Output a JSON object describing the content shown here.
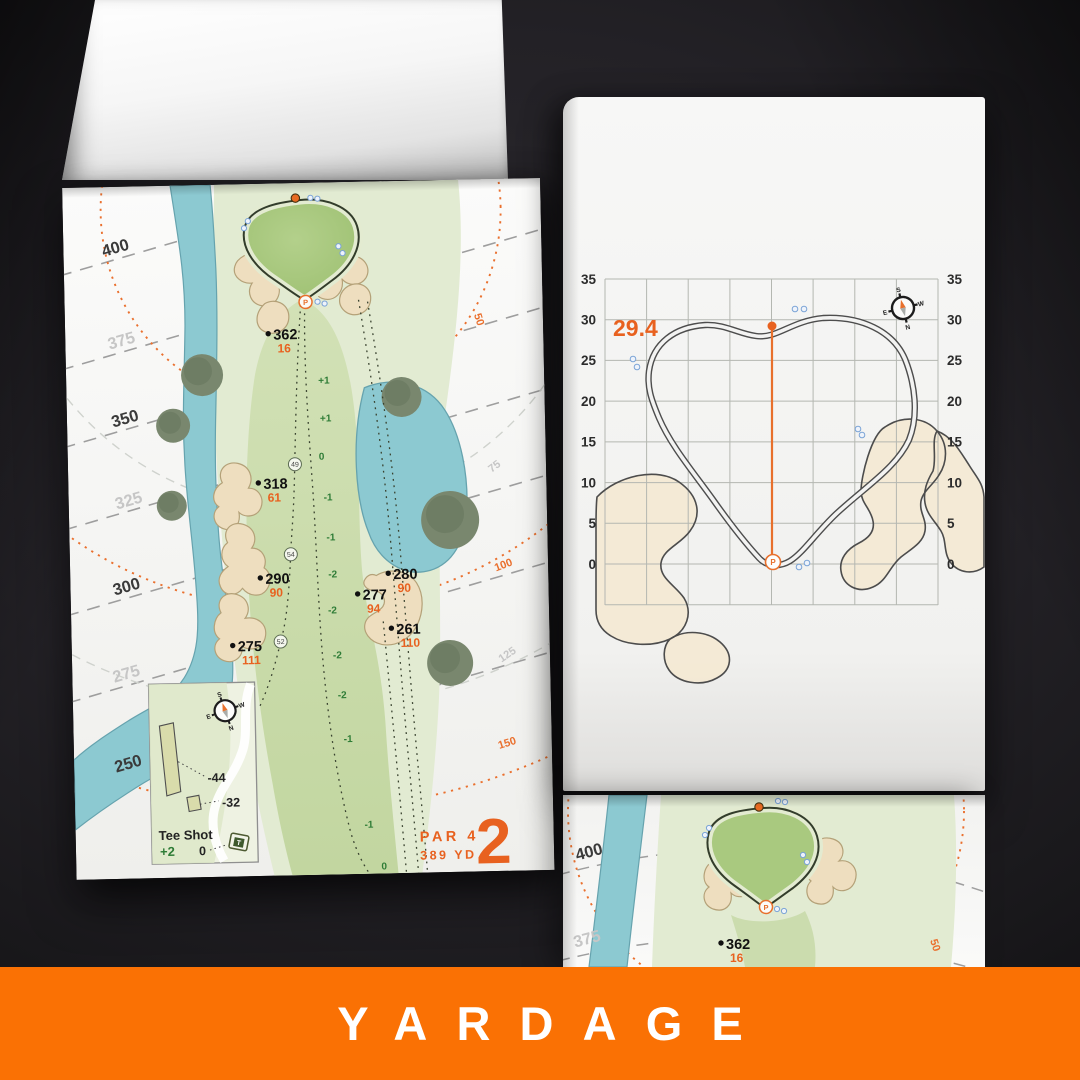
{
  "banner": {
    "label": "YARDAGE"
  },
  "colors": {
    "banner_orange": "#fa7104",
    "accent_orange": "#e8611f",
    "arc_orange": "#ea702e",
    "water": "#8cc9d1",
    "fairway": "#cbdcae",
    "rough": "#e2ebd2",
    "putting_green": "#a9c97f",
    "sand": "#eedebf",
    "value_green": "#2e7c36",
    "label_dark": "#3a3a3a",
    "label_light": "#c6c6c6"
  },
  "hole_card": {
    "par": "PAR 4",
    "yards": "389 YD",
    "number": "2"
  },
  "left_map": {
    "tee_lines": [
      "400",
      "375",
      "350",
      "325",
      "300",
      "275",
      "250"
    ],
    "pin_arcs": [
      "50",
      "75",
      "100",
      "125",
      "150"
    ],
    "markers": [
      {
        "dist": "362",
        "front": "16"
      },
      {
        "dist": "318",
        "front": "61"
      },
      {
        "dist": "290",
        "front": "90"
      },
      {
        "dist": "280",
        "front": "90"
      },
      {
        "dist": "277",
        "front": "94"
      },
      {
        "dist": "261",
        "front": "110"
      },
      {
        "dist": "275",
        "front": "111"
      }
    ],
    "center_vals": [
      "+1",
      "+1",
      "0",
      "-1",
      "-1",
      "-2",
      "-2",
      "-2",
      "-2",
      "-1",
      "-1",
      "0"
    ],
    "circle_vals": [
      "49",
      "54",
      "52"
    ],
    "pin_letter": "P",
    "inset": {
      "title": "Tee Shot",
      "score": "+2",
      "zero": "0",
      "long": "-44",
      "short": "-32",
      "tee": "T"
    },
    "compass": {
      "n": "N",
      "s": "S",
      "e": "E",
      "w": "W"
    }
  },
  "green_chart": {
    "depth": "29.4",
    "y_axis": [
      "35",
      "30",
      "25",
      "20",
      "15",
      "10",
      "5",
      "0"
    ],
    "pin_letter": "P",
    "compass": {
      "n": "N",
      "s": "S",
      "e": "E",
      "w": "W"
    }
  },
  "next_page": {
    "tee_lines": [
      "400",
      "375"
    ],
    "marker": {
      "dist": "362",
      "front": "16"
    },
    "pin_arc": "50",
    "pin_letter": "P"
  }
}
